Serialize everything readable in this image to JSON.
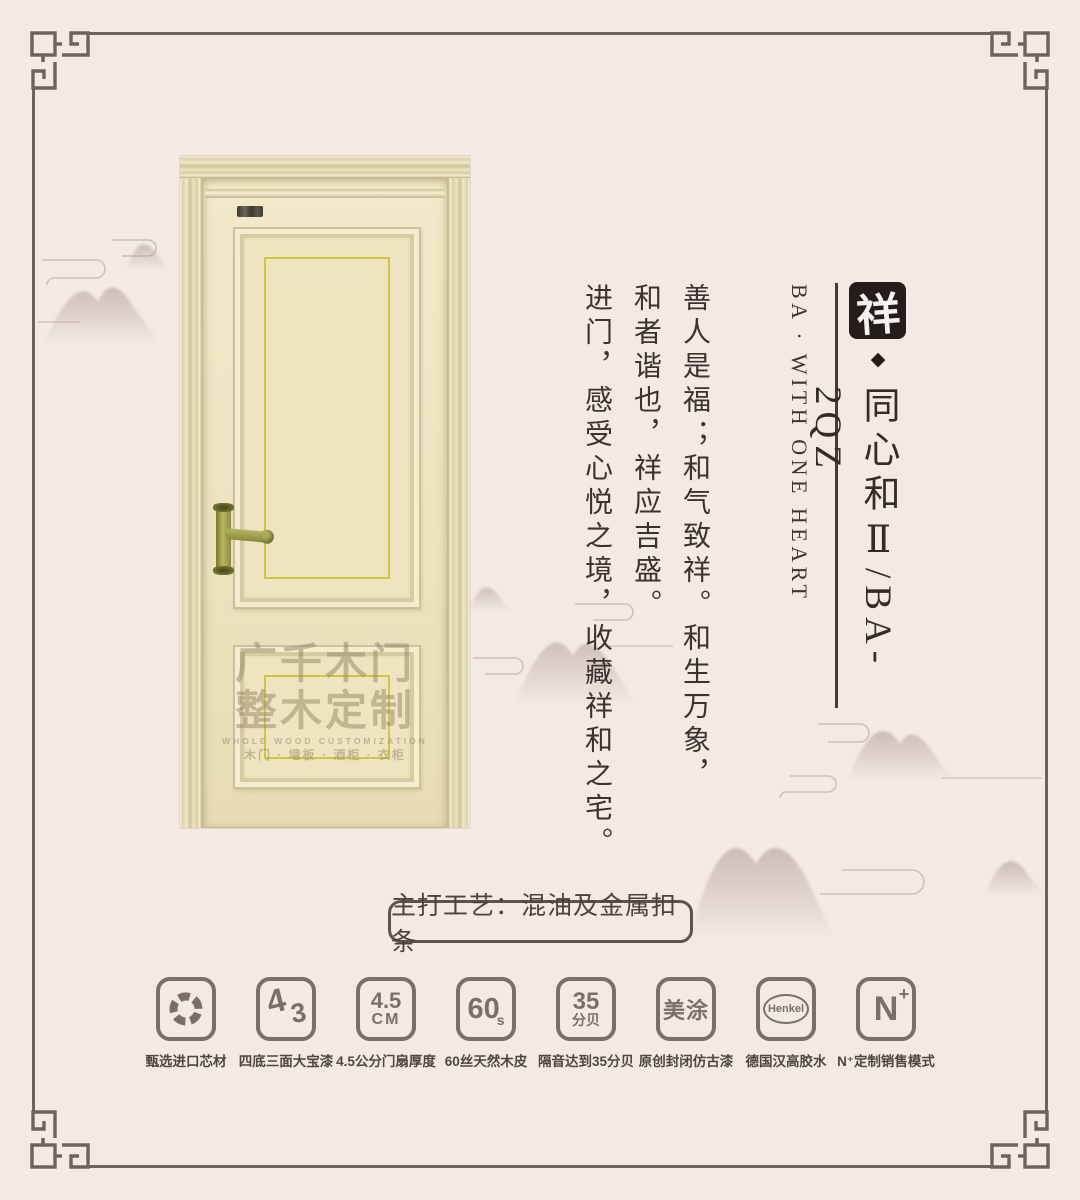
{
  "colors": {
    "bg": "#f3eae4",
    "frame": "#6e6260",
    "ink": "#3a332f",
    "gold": "#d2c53e",
    "seal": "#241d1b",
    "icon": "#7c6f69",
    "label": "#4f4641"
  },
  "title_block": {
    "seal": "祥",
    "diamond": "◆",
    "title_cn": "同心和Ⅱ/BA-2QZ",
    "title_en": "BA · WITH ONE HEART"
  },
  "poem": {
    "columns": [
      "善人是福；和气致祥。和生万象，",
      "和者谐也，祥应吉盛。",
      "进门，感受心悦之境，收藏祥和之宅。"
    ]
  },
  "door": {
    "watermark_line1": "广千木门",
    "watermark_line2": "整木定制",
    "watermark_en": "WHOLE WOOD CUSTOMIZATION",
    "watermark_sub": "木门 · 墙板 · 酒柜 · 衣柜"
  },
  "banner": {
    "text": "主打工艺：混油及金属扣条"
  },
  "features": [
    {
      "label": "甄选进口芯材",
      "glyph": {}
    },
    {
      "label": "四底三面大宝漆",
      "glyph": {
        "a": "4",
        "b": "3"
      }
    },
    {
      "label": "4.5公分门扇厚度",
      "glyph": {
        "a": "4.5",
        "b": "CM"
      }
    },
    {
      "label": "60丝天然木皮",
      "glyph": {
        "a": "60",
        "b": "s"
      }
    },
    {
      "label": "隔音达到35分贝",
      "glyph": {
        "a": "35",
        "b": "分贝"
      }
    },
    {
      "label": "原创封闭仿古漆",
      "glyph": {
        "a": "美涂"
      }
    },
    {
      "label": "德国汉高胶水",
      "glyph": {
        "a": "Henkel"
      }
    },
    {
      "label": "N⁺定制销售模式",
      "glyph": {
        "a": "N",
        "b": "+"
      }
    }
  ]
}
